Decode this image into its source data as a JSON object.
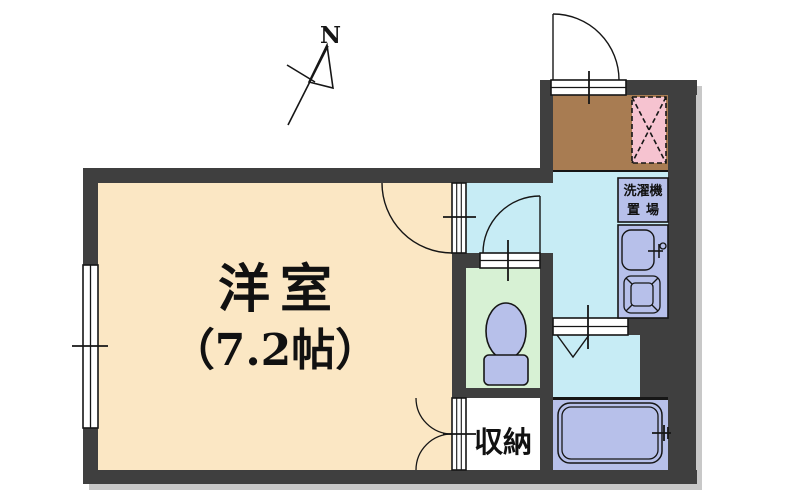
{
  "plan": {
    "compass": {
      "label": "N"
    },
    "main_room": {
      "name": "洋室",
      "size": "（7.2帖）"
    },
    "storage": {
      "label": "収納"
    },
    "laundry_area": {
      "label_line1": "洗濯機",
      "label_line2": "置場"
    },
    "colors": {
      "wall": "#3f3f3f",
      "main_room_floor": "#fbe7c4",
      "hallway_kitchen_floor": "#c7ecf5",
      "toilet_room_floor": "#d7f1d4",
      "bathroom_floor": "#b7c0ea",
      "fixtures": "#b7c0ea",
      "entrance_floor": "#a87c52",
      "refrigerator_space": "#f6c3d0",
      "storage_floor": "#ffffff",
      "line": "#161616"
    }
  }
}
